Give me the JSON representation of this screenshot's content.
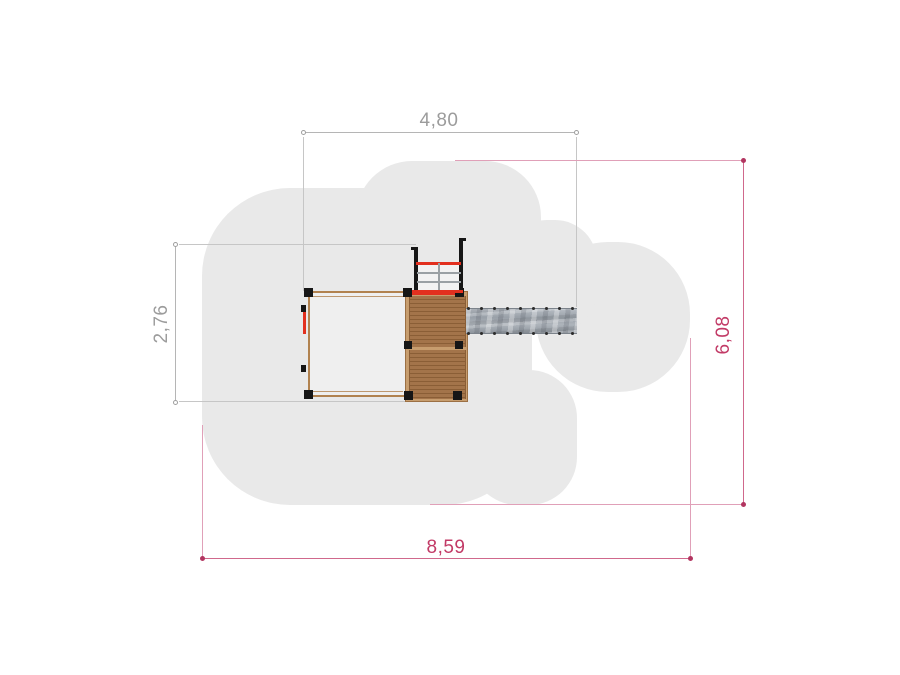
{
  "drawing": {
    "title": "Playground equipment top-view plan with safety area",
    "background": "#ffffff",
    "safety_area_color": "#e9e9e9"
  },
  "dimensions": {
    "top_width": {
      "value": "4,80",
      "orientation": "horizontal",
      "style": "gray"
    },
    "left_depth": {
      "value": "2,76",
      "orientation": "vertical",
      "style": "gray"
    },
    "right_depth": {
      "value": "6,08",
      "orientation": "vertical",
      "style": "crimson"
    },
    "bottom_width": {
      "value": "8,59",
      "orientation": "horizontal",
      "style": "crimson"
    }
  },
  "colors": {
    "dim_gray_line": "#b5b5b5",
    "dim_gray_text": "#9c9c9c",
    "dim_crimson_line": "#d0688c",
    "dim_crimson_text": "#c23a66",
    "wood_frame": "#b1824f",
    "deck_plank": "#a3744a",
    "deck_plank_gap": "#8a5e36",
    "accent_red": "#e2301f",
    "post_black": "#161616",
    "slide_gray": "#a2a8b0"
  },
  "structure": {
    "parts": [
      "safety-area",
      "platform-frame",
      "wooden-deck",
      "climbing-ladder",
      "slide"
    ],
    "slide_bolts_per_edge": 9
  }
}
